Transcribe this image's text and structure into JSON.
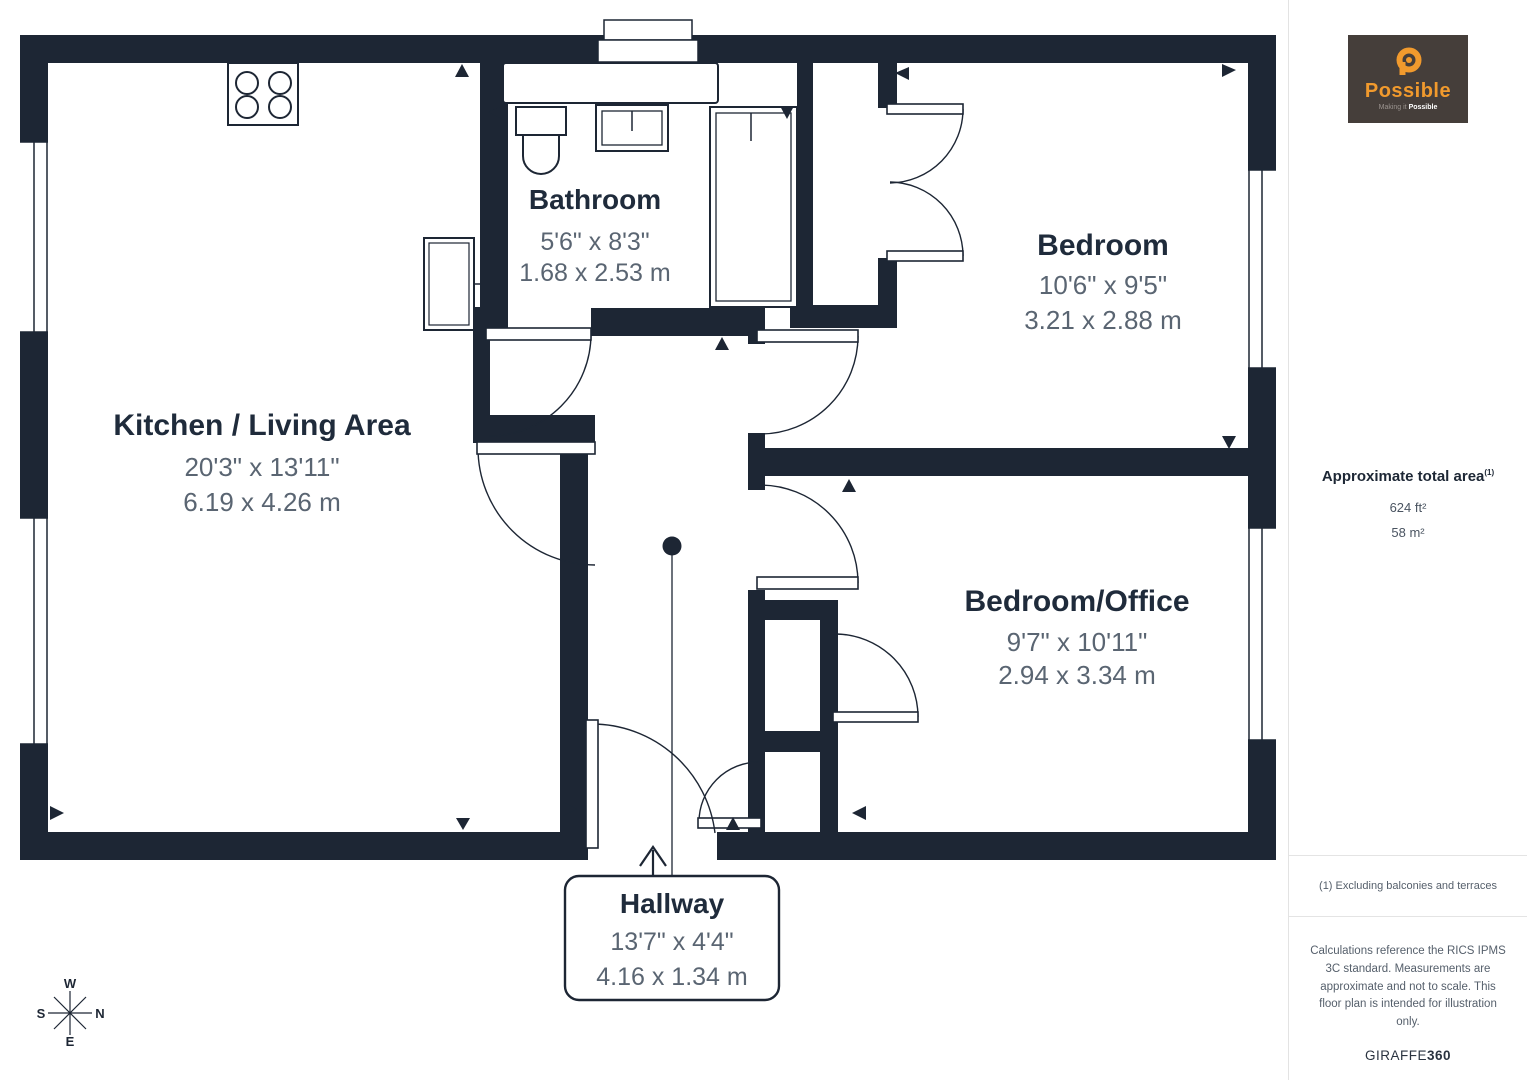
{
  "floorplan": {
    "rooms": [
      {
        "id": "kitchen",
        "name": "Kitchen / Living Area",
        "imperial": "20'3\" x 13'11\"",
        "metric": "6.19 x 4.26 m"
      },
      {
        "id": "bathroom",
        "name": "Bathroom",
        "imperial": "5'6\" x 8'3\"",
        "metric": "1.68 x 2.53 m"
      },
      {
        "id": "bedroom",
        "name": "Bedroom",
        "imperial": "10'6\" x 9'5\"",
        "metric": "3.21 x 2.88 m"
      },
      {
        "id": "bedroom_office",
        "name": "Bedroom/Office",
        "imperial": "9'7\" x 10'11\"",
        "metric": "2.94 x 3.34 m"
      },
      {
        "id": "hallway",
        "name": "Hallway",
        "imperial": "13'7\" x 4'4\"",
        "metric": "4.16 x 1.34 m"
      }
    ],
    "compass": {
      "top": "W",
      "right": "N",
      "bottom": "E",
      "left": "S"
    }
  },
  "sidebar": {
    "logo": {
      "brand": "Possible",
      "tagline_prefix": "Making it ",
      "tagline_bold": "Possible"
    },
    "area": {
      "title": "Approximate total area",
      "superscript": "(1)",
      "imperial": "624 ft²",
      "metric": "58 m²"
    },
    "footnote": "(1) Excluding balconies and terraces",
    "disclaimer": "Calculations reference the RICS IPMS 3C standard. Measurements are approximate and not to scale. This floor plan is intended for illustration only.",
    "credit_regular": "GIRAFFE",
    "credit_bold": "360"
  },
  "colors": {
    "wall": "#1D2634",
    "room_name": "#1F2B3B",
    "dimension": "#5A6572",
    "logo_bg": "#453E3A",
    "logo_orange": "#F19A2D"
  }
}
